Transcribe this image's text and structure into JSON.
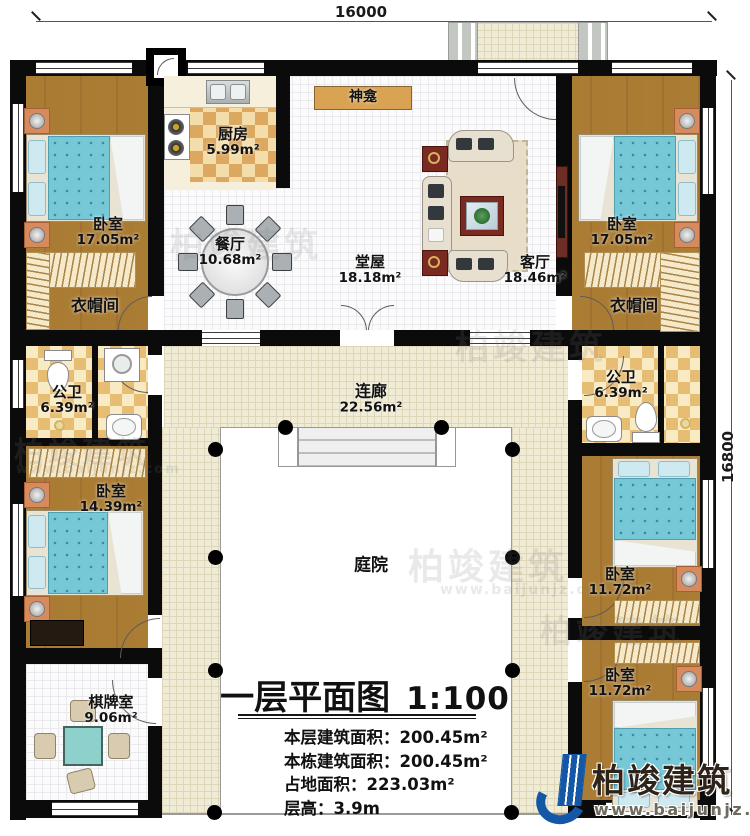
{
  "dimensions": {
    "width_top": "16000",
    "height_right": "16800"
  },
  "rooms": [
    {
      "id": "bedroom-tl",
      "name": "卧室",
      "area": "17.05m²"
    },
    {
      "id": "kitchen",
      "name": "厨房",
      "area": "5.99m²"
    },
    {
      "id": "dining",
      "name": "餐厅",
      "area": "10.68m²"
    },
    {
      "id": "hall",
      "name": "堂屋",
      "area": "18.18m²"
    },
    {
      "id": "living",
      "name": "客厅",
      "area": "18.46m²"
    },
    {
      "id": "bedroom-tr",
      "name": "卧室",
      "area": "17.05m²"
    },
    {
      "id": "cloak-left",
      "name": "衣帽间"
    },
    {
      "id": "cloak-right",
      "name": "衣帽间"
    },
    {
      "id": "bath-left",
      "name": "公卫",
      "area": "6.39m²"
    },
    {
      "id": "bath-right",
      "name": "公卫",
      "area": "6.39m²"
    },
    {
      "id": "bedroom-left",
      "name": "卧室",
      "area": "14.39m²"
    },
    {
      "id": "corridor",
      "name": "连廊",
      "area": "22.56m²"
    },
    {
      "id": "courtyard",
      "name": "庭院"
    },
    {
      "id": "chess-room",
      "name": "棋牌室",
      "area": "9.06m²"
    },
    {
      "id": "bedroom-r1",
      "name": "卧室",
      "area": "11.72m²"
    },
    {
      "id": "bedroom-r2",
      "name": "卧室",
      "area": "11.72m²"
    },
    {
      "id": "shrine",
      "name": "神龛"
    }
  ],
  "title_block": {
    "title": "一层平面图",
    "scale": "1:100",
    "info": [
      "本层建筑面积：200.45m²",
      "本栋建筑面积：200.45m²",
      "占地面积：223.03m²",
      "层高：3.9m"
    ]
  },
  "branding": {
    "name": "柏竣建筑",
    "url": "www.baijunjz.com"
  },
  "watermark": {
    "name": "柏竣建筑",
    "url": "www.baijunjz.com"
  },
  "colors": {
    "wall": "#0b0b0b",
    "wood_floor": "#a87a31",
    "kitchen_checker": "#dca75f",
    "bed_teal": "#76c8d7",
    "shrine_tan": "#d9a353",
    "corridor_tile": "#f0ebd5",
    "logo_blue": "#1357a6"
  }
}
